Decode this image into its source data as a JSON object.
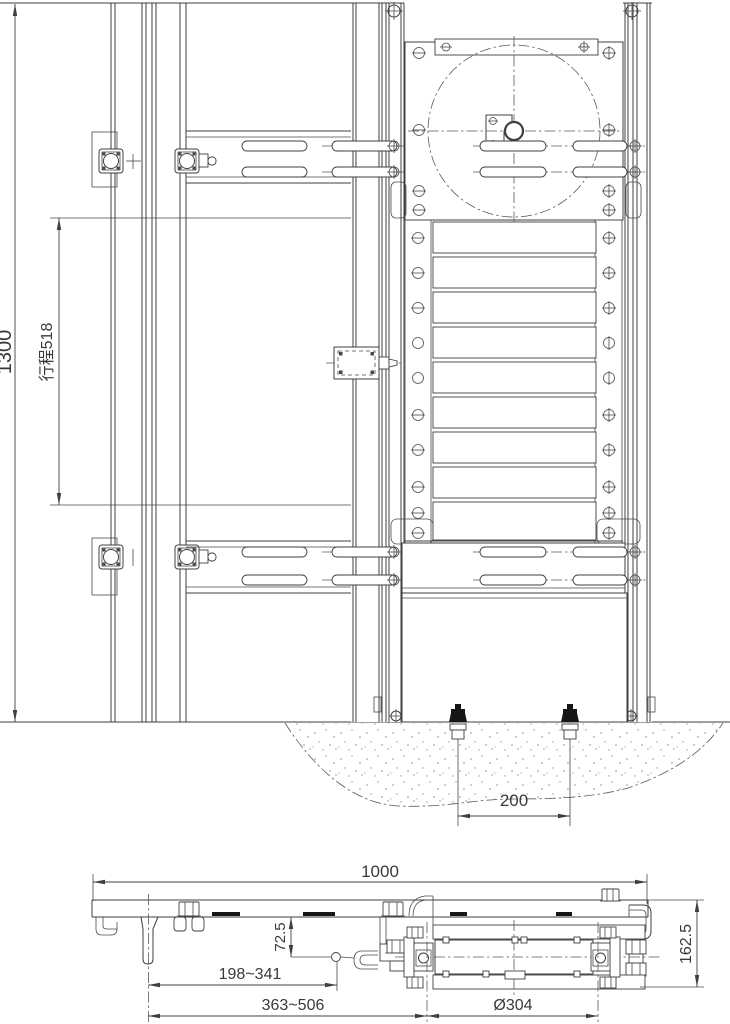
{
  "drawing": {
    "type": "engineering-drawing",
    "views": {
      "front": {
        "name": "front-elevation",
        "dimensions": {
          "overall_height": "1300",
          "stroke": "行程518",
          "anchor_bolt_spacing": "200"
        }
      },
      "side": {
        "name": "side-section",
        "dimensions": {
          "overall_length": "1000",
          "drop_offset": "72.5",
          "reach_range_min": "198~341",
          "reach_range_max": "363~506",
          "roller_diameter": "Ø304",
          "section_height": "162.5"
        }
      }
    },
    "colors": {
      "line": "#3f3f3f",
      "centerline": "#5a5a5a",
      "text": "#3a3a3a",
      "ground_stipple": "#909090",
      "bolt_head": "#161616",
      "background": "#ffffff"
    }
  }
}
